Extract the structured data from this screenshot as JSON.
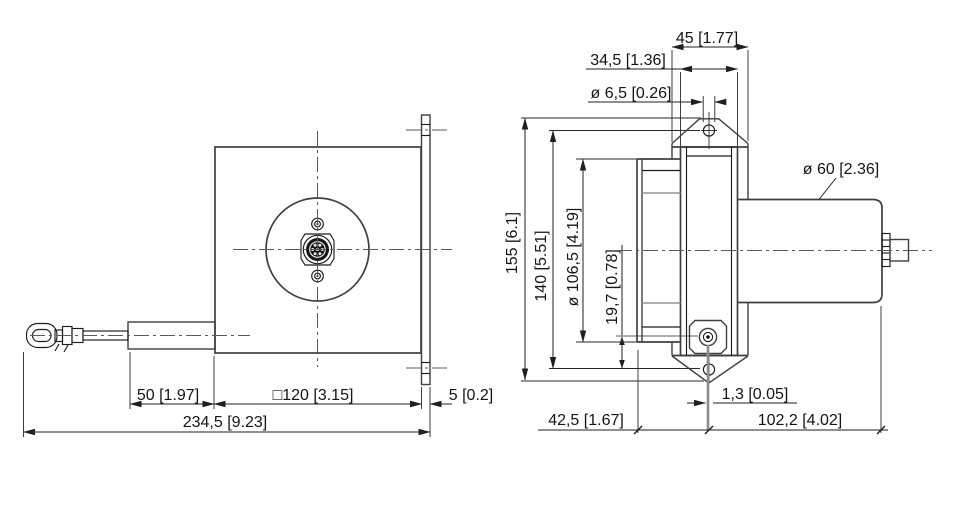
{
  "drawing": {
    "type": "dimensional engineering drawing, draw-wire sensor, two orthographic views",
    "units": "mm [inch]"
  },
  "labels": {
    "front": {
      "cable_clip_to_housing": "50 [1.97]",
      "housing_square": "□120 [3.15]",
      "plate_thickness": "5 [0.2]",
      "overall_length": "234,5 [9.23]"
    },
    "side": {
      "plate_width": "45 [1.77]",
      "body_depth": "34,5 [1.36]",
      "mount_hole_dia": "ø 6,5 [0.26]",
      "cylinder_dia": "ø 60 [2.36]",
      "plate_height": "155 [6.1]",
      "hole_spacing": "140 [5.51]",
      "drum_dia": "ø 106,5 [4.19]",
      "cable_exit_offset": "19,7 [0.78]",
      "cable_lateral_offset": "1,3 [0.05]",
      "front_depth": "42,5 [1.67]",
      "rear_length": "102,2 [4.02]"
    }
  }
}
